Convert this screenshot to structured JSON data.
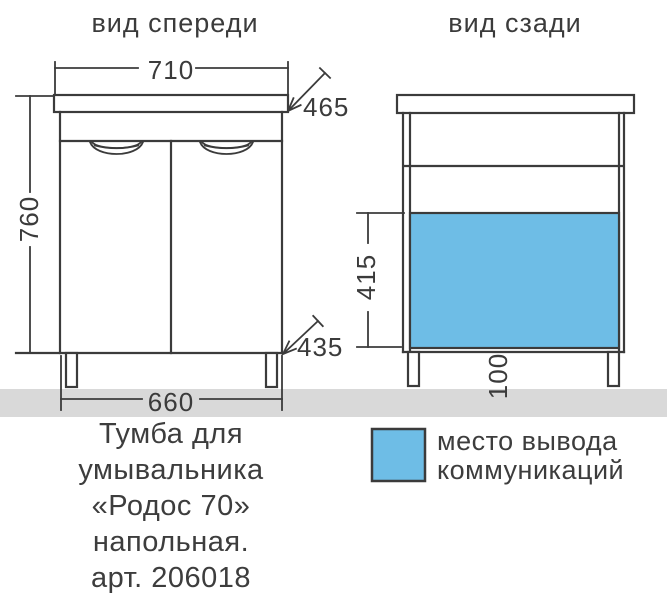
{
  "titles": {
    "front": "вид спереди",
    "back": "вид сзади"
  },
  "dimensions": {
    "top_width": "710",
    "top_depth": "465",
    "height": "760",
    "bottom_depth": "435",
    "bottom_width": "660",
    "cutout_height": "415",
    "cutout_bottom_offset": "100"
  },
  "caption": {
    "lines": [
      "Тумба для",
      "умывальника",
      "«Родос 70»",
      "напольная.",
      "арт. 206018"
    ]
  },
  "legend": {
    "line1": "место вывода",
    "line2": "коммуникаций"
  },
  "colors": {
    "line": "#3b3b3b",
    "cutout_blue": "#6ebde6",
    "floor_gray": "#d9d9d9",
    "background": "#ffffff"
  }
}
